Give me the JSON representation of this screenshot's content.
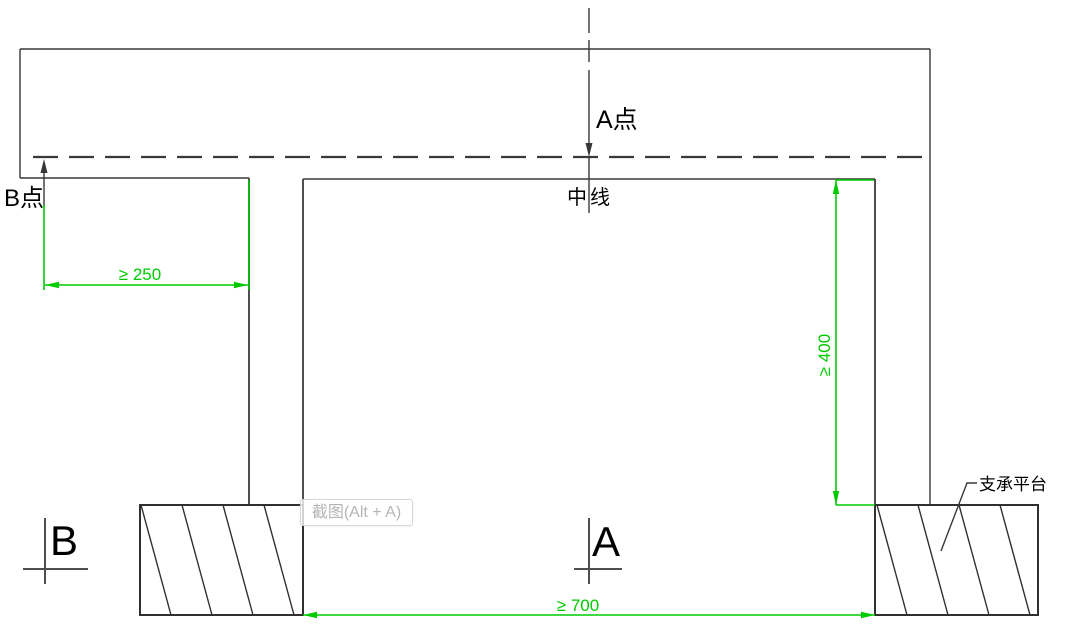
{
  "colors": {
    "dimension_green": "#00cb00",
    "line_dark": "#383838",
    "line_medium": "#4f4f4f",
    "hatch": "#303030",
    "label_black": "#000000",
    "hint_text": "#b5b5b5",
    "hint_border": "#d6d6d6"
  },
  "labels": {
    "point_a": "A点",
    "point_b": "B点",
    "centerline": "中线",
    "support_platform": "支承平台",
    "section_a": "A",
    "section_b": "B"
  },
  "dimensions": {
    "b_edge_distance": "≥ 250",
    "drop_height": "≥ 400",
    "support_span": "≥ 700"
  },
  "overlay": {
    "screenshot_hint": "截图(Alt + A)"
  }
}
